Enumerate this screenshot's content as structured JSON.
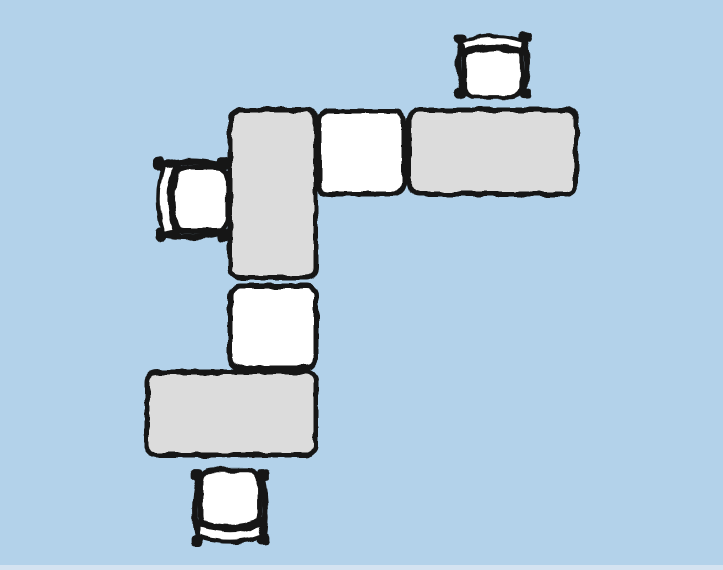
{
  "canvas": {
    "width": 723,
    "height": 570,
    "background": "#b3d2ea",
    "bottom_strip_color": "#d4e3f1",
    "bottom_strip_height": 5
  },
  "colors": {
    "outline": "#141414",
    "gray": "#dcdcdc",
    "white": "#ffffff"
  },
  "desks": [
    {
      "id": "desk-left-vertical",
      "x": 230,
      "y": 110,
      "w": 86,
      "h": 168,
      "fill": "gray"
    },
    {
      "id": "desk-top-middle",
      "x": 319,
      "y": 111,
      "w": 85,
      "h": 83,
      "fill": "white"
    },
    {
      "id": "desk-top-right",
      "x": 409,
      "y": 110,
      "w": 167,
      "h": 84,
      "fill": "gray"
    },
    {
      "id": "desk-middle",
      "x": 230,
      "y": 286,
      "w": 86,
      "h": 82,
      "fill": "white"
    },
    {
      "id": "desk-bottom",
      "x": 147,
      "y": 372,
      "w": 169,
      "h": 83,
      "fill": "gray"
    }
  ],
  "chairs": [
    {
      "id": "chair-top-right",
      "x": 453,
      "y": 30,
      "w": 80,
      "h": 70,
      "facing": "down"
    },
    {
      "id": "chair-left",
      "x": 151,
      "y": 155,
      "w": 80,
      "h": 88,
      "facing": "right"
    },
    {
      "id": "chair-bottom",
      "x": 189,
      "y": 467,
      "w": 82,
      "h": 82,
      "facing": "up"
    }
  ]
}
